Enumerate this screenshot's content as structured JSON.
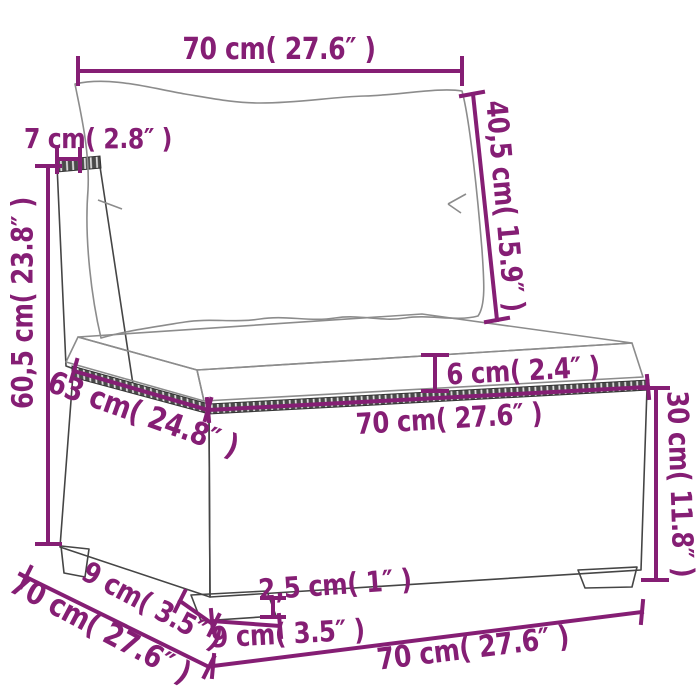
{
  "colors": {
    "dimension": "#851E74",
    "outline": "#454545",
    "background": "#FFFFFF"
  },
  "dimensions": {
    "back_cushion_width": "70 cm( 27.6″ )",
    "back_cushion_height": "40,5 cm( 15.9″ )",
    "back_panel_thickness": "7 cm( 2.8″ )",
    "overall_height": "60,5 cm( 23.8″ )",
    "seat_cushion_thickness": "6 cm( 2.4″ )",
    "seat_depth": "63 cm( 24.8″ )",
    "seat_width": "70 cm( 27.6″ )",
    "base_height": "30 cm( 11.8″ )",
    "overall_depth": "70 cm( 27.6″ )",
    "foot_depth": "9 cm( 3.5″ )",
    "foot_height": "2,5 cm( 1″ )",
    "foot_width": "9 cm( 3.5″ )",
    "overall_width": "70 cm( 27.6″ )"
  }
}
